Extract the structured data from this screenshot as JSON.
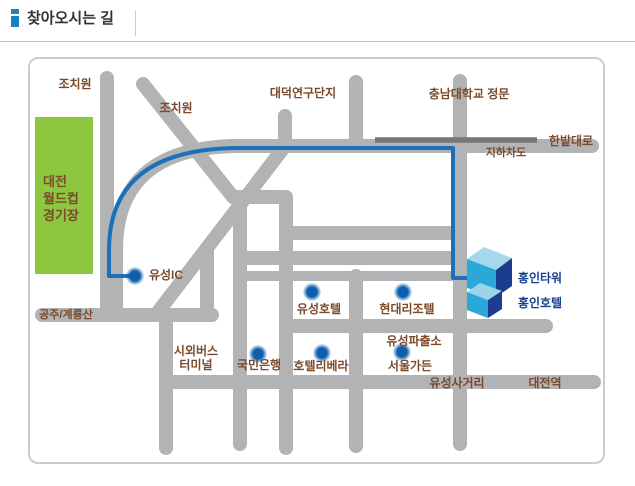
{
  "header": {
    "title": "찾아오시는 길"
  },
  "map": {
    "labels": {
      "jochiwon1": "조치원",
      "jochiwon2": "조치원",
      "daedeok_complex": "대덕연구단지",
      "chungnam_gate": "충남대학교 정문",
      "hanbat_daero": "한밭대로",
      "underpass": "지하차도",
      "stadium": "대전\n월드컵\n경기장",
      "gongju_gyeryong": "공주/계룡산",
      "yuseong_ic": "유성IC",
      "bus_terminal": "시외버스\n터미널",
      "kookmin_bank": "국민은행",
      "yuseong_hotel": "유성호텔",
      "hyundai_rizotel": "현대리조텔",
      "hotel_riviera": "호텔리베라",
      "yuseong_police": "유성파출소",
      "seoul_garden": "서울가든",
      "yuseong_sageori": "유성사거리",
      "daejeon_station": "대전역",
      "hongin_tower": "홍인타워",
      "hongin_hotel": "홍인호텔"
    },
    "marker_dots": [
      "유성IC",
      "유성호텔",
      "현대리조텔",
      "국민은행",
      "호텔리베라",
      "서울가든"
    ],
    "route_description": "blue guide line from 한밭대로 / 유성IC to 홍인타워·홍인호텔"
  },
  "colors": {
    "road_gray": "#b1b3b5",
    "underpass_gray": "#76777a",
    "route_blue": "#1d6fba",
    "marker_blue": "#0d5fae",
    "stadium_green": "#8dc63f",
    "label_brown": "#7b4a2b",
    "label_navy": "#16418f",
    "building_top": "#a5d8ea",
    "building_front": "#2ba7da",
    "building_side": "#1c3c8e",
    "header_icon_blue": "#1e7fc0"
  }
}
